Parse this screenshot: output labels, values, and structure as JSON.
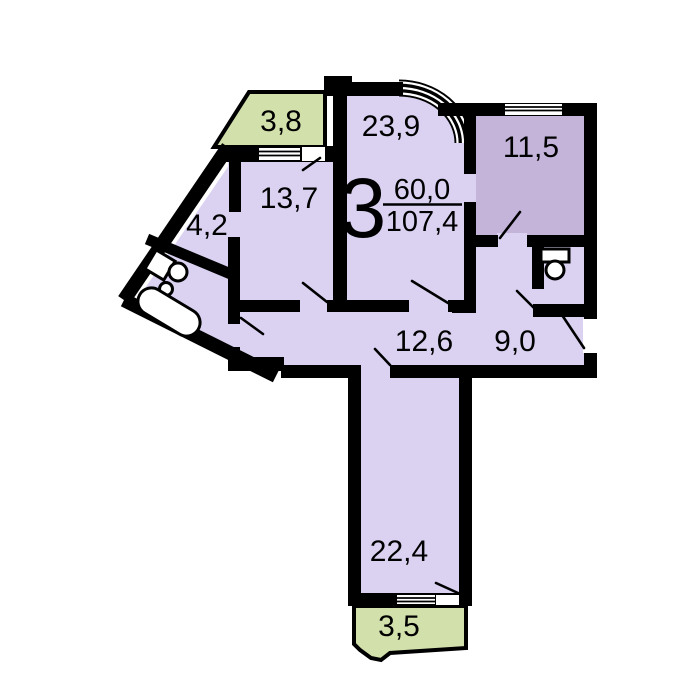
{
  "apartment": {
    "rooms_label": "3",
    "living_area": "60,0",
    "total_area": "107,4"
  },
  "rooms": {
    "living": {
      "area": "23,9"
    },
    "bedroom_top_right": {
      "area": "11,5"
    },
    "bedroom_top_left": {
      "area": "13,7"
    },
    "hall_small": {
      "area": "4,2"
    },
    "corridor": {
      "area": "12,6"
    },
    "kitchen": {
      "area": "9,0"
    },
    "bedroom_bottom": {
      "area": "22,4"
    },
    "balcony_top": {
      "area": "3,8"
    },
    "balcony_bottom": {
      "area": "3,5"
    }
  },
  "colors": {
    "floor_light": "#dbd2f2",
    "floor_dark": "#c5b4da",
    "balcony_green": "#d2e0ac",
    "wall": "#000000",
    "background": "#ffffff"
  }
}
